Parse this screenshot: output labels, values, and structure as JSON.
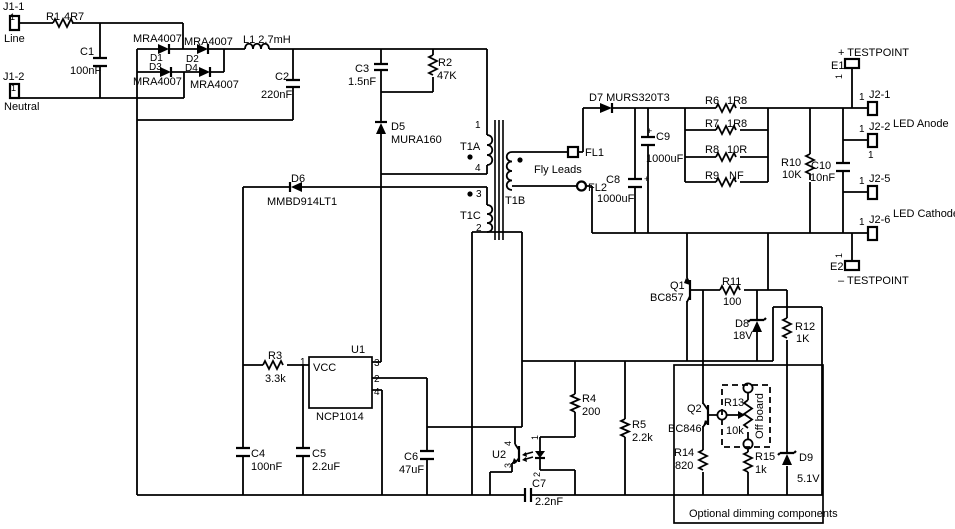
{
  "labels": {
    "j1_1": "J1-1",
    "j1_1_pin": "1",
    "line": "Line",
    "j1_2": "J1-2",
    "j1_2_pin": "1",
    "neutral": "Neutral",
    "r1_ref": "R1",
    "r1_val": "4R7",
    "c1_ref": "C1",
    "c1_val": "100nF",
    "d1_part": "MRA4007",
    "d2_part": "MRA4007",
    "d3_part": "MRA4007",
    "d4_part": "MRA4007",
    "d1_ref": "D1",
    "d2_ref": "D2",
    "d3_ref": "D3",
    "d4_ref": "D4",
    "l1": "L1 2.7mH",
    "c2_ref": "C2",
    "c2_val": "220nF",
    "c3_ref": "C3",
    "c3_val": "1.5nF",
    "r2_ref": "R2",
    "r2_val": "47K",
    "d5_ref": "D5",
    "d5_part": "MURA160",
    "d6_ref": "D6",
    "d6_part": "MMBD914LT1",
    "t1a": "T1A",
    "t1a_pin1": "1",
    "t1a_pin4": "4",
    "t1b": "T1B",
    "t1c": "T1C",
    "t1c_pin3": "3",
    "t1c_pin2": "2",
    "fly_leads": "Fly Leads",
    "fl1": "FL1",
    "fl2": "FL2",
    "d7": "D7 MURS320T3",
    "c8_ref": "C8",
    "c8_val": "1000uF",
    "c8_plus": "+",
    "c9_ref": "C9",
    "c9_val": "1000uF",
    "c9_plus": "+",
    "r6_ref": "R6",
    "r6_val": "1R8",
    "r7_ref": "R7",
    "r7_val": "1R8",
    "r8_ref": "R8",
    "r8_val": "10R",
    "r9_ref": "R9",
    "r9_val": "NF",
    "r10_ref": "R10",
    "r10_val": "10K",
    "c10_ref": "C10",
    "c10_val": "10nF",
    "e1_ref": "E1",
    "e1_tp": "+ TESTPOINT",
    "e1_pin": "1",
    "e2_ref": "E2",
    "e2_tp": "– TESTPOINT",
    "e2_pin": "1",
    "j2_1": "J2-1",
    "j2_1_pin": "1",
    "j2_2": "J2-2",
    "j2_2_pin": "1",
    "j2_2_pin_b": "1",
    "j2_5": "J2-5",
    "j2_5_pin": "1",
    "j2_6": "J2-6",
    "j2_6_pin": "1",
    "led_anode": "LED Anode",
    "led_cathode": "LED Cathode",
    "q1_ref": "Q1",
    "q1_part": "BC857",
    "r11_ref": "R11",
    "r11_val": "100",
    "d8_ref": "D8",
    "d8_val": "18V",
    "r12_ref": "R12",
    "r12_val": "1K",
    "r3_ref": "R3",
    "r3_val": "3.3k",
    "u1_ref": "U1",
    "u1_part": "NCP1014",
    "u1_vcc": "VCC",
    "u1_pin1": "1",
    "u1_pin2": "2",
    "u1_pin3": "3",
    "u1_pin4": "4",
    "c4_ref": "C4",
    "c4_val": "100nF",
    "c5_ref": "C5",
    "c5_val": "2.2uF",
    "c6_ref": "C6",
    "c6_val": "47uF",
    "u2_ref": "U2",
    "u2_pin1": "1",
    "u2_pin2": "2",
    "u2_pin3": "3",
    "u2_pin4": "4",
    "c7_ref": "C7",
    "c7_val": "2.2nF",
    "r4_ref": "R4",
    "r4_val": "200",
    "r5_ref": "R5",
    "r5_val": "2.2k",
    "q2_ref": "Q2",
    "q2_part": "BC846",
    "r13_ref": "R13",
    "r13_val": "10k",
    "off_board": "Off board",
    "r14_ref": "R14",
    "r14_val": "820",
    "r15_ref": "R15",
    "r15_val": "1k",
    "d9_ref": "D9",
    "d9_val": "5.1V",
    "optional": "Optional dimming components"
  }
}
